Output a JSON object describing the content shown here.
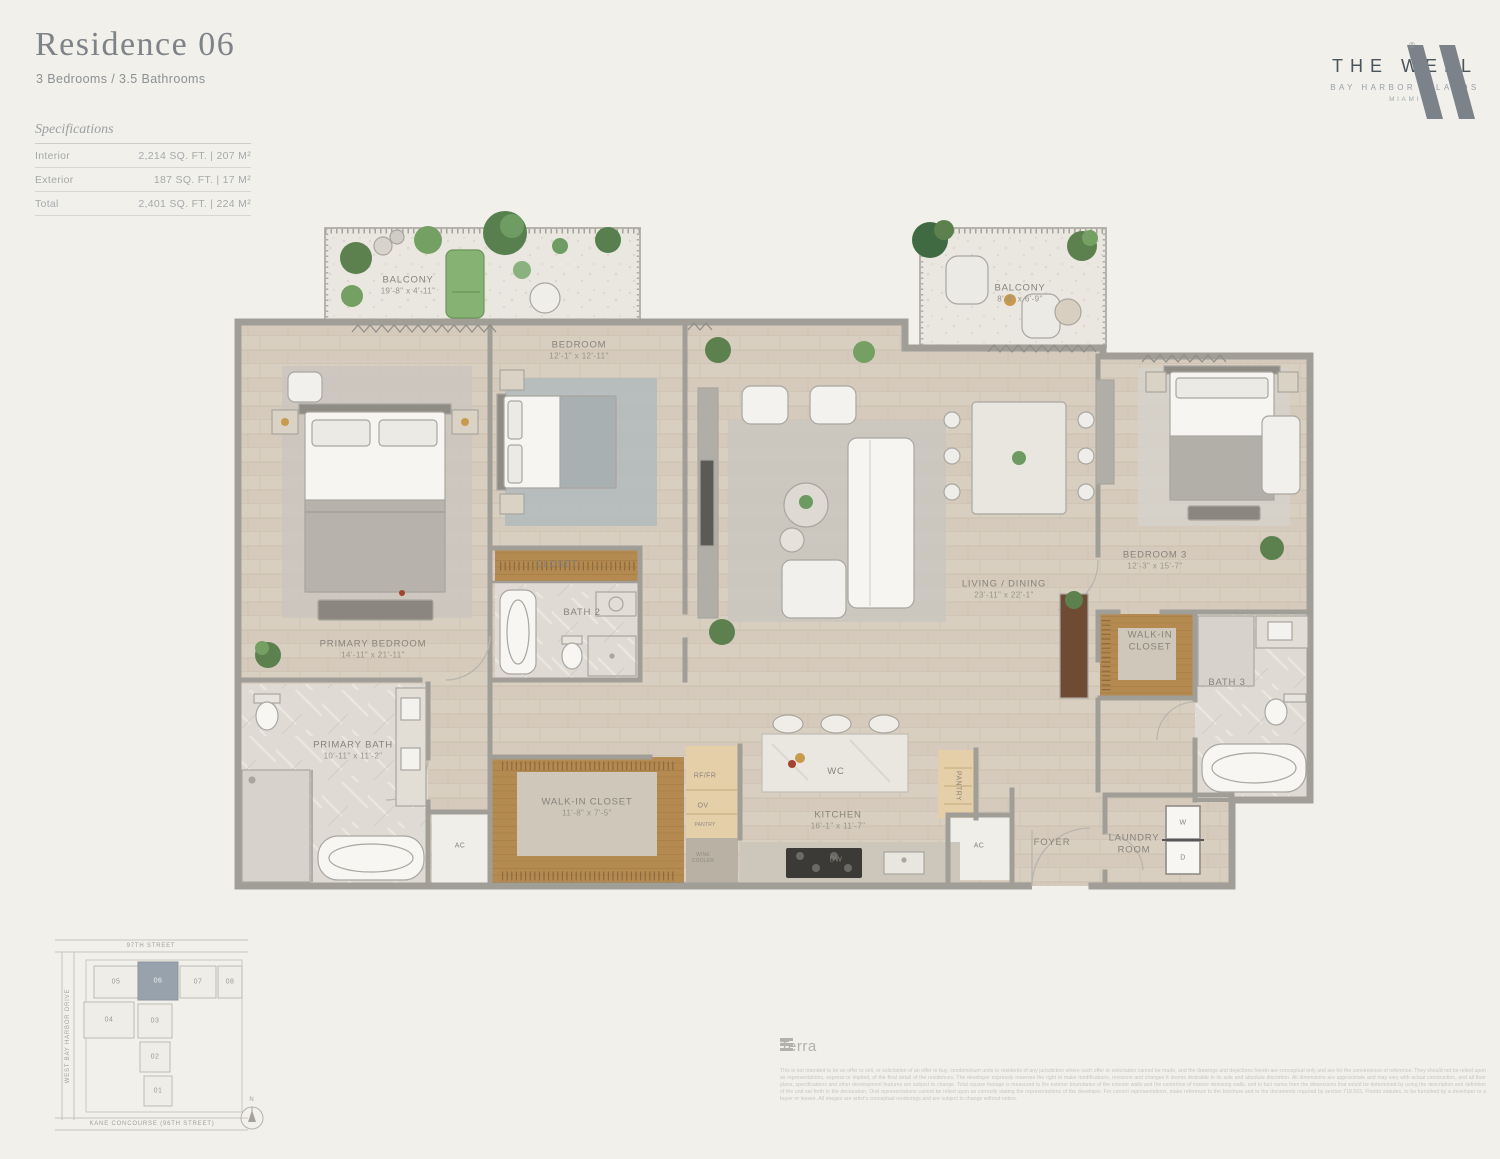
{
  "header": {
    "title": "Residence 06",
    "subtitle": "3 Bedrooms / 3.5 Bathrooms"
  },
  "specs": {
    "heading": "Specifications",
    "rows": [
      {
        "label": "Interior",
        "value": "2,214 SQ. FT.  |  207 M²"
      },
      {
        "label": "Exterior",
        "value": "187 SQ. FT.  |  17 M²"
      },
      {
        "label": "Total",
        "value": "2,401 SQ. FT.  |  224 M²"
      }
    ]
  },
  "brand": {
    "wordmark": "THE WELL",
    "sub": "BAY HARBOR ISLANDS",
    "city": "MIAMI",
    "registered": "®"
  },
  "plan": {
    "labels": {
      "balcony1": {
        "name": "BALCONY",
        "dims": "19'-8\" x 4'-11\""
      },
      "balcony2": {
        "name": "BALCONY",
        "dims": "8'-6\" x 6'-9\""
      },
      "bedroom2": {
        "name": "BEDROOM",
        "dims": "12'-1\" x 12'-11\""
      },
      "living": {
        "name": "LIVING / DINING",
        "dims": "23'-11\" x 22'-1\""
      },
      "bedroom3": {
        "name": "BEDROOM 3",
        "dims": "12'-3\" x 15'-7\""
      },
      "wic3": {
        "line1": "WALK-IN",
        "line2": "CLOSET"
      },
      "primary_bedroom": {
        "name": "PRIMARY BEDROOM",
        "dims": "14'-11\" x 21'-11\""
      },
      "primary_bath": {
        "name": "PRIMARY BATH",
        "dims": "10'-11\" x 11'-2\""
      },
      "closet2": {
        "name": "CLOSET"
      },
      "bath2": {
        "name": "BATH 2"
      },
      "bath3": {
        "name": "BATH 3"
      },
      "wic_primary": {
        "name": "WALK-IN CLOSET",
        "dims": "11'-8\" x 7'-5\""
      },
      "kitchen": {
        "name": "KITCHEN",
        "dims": "16'-1\" x 11'-7\""
      },
      "wc": {
        "name": "WC"
      },
      "dw": {
        "name": "DW"
      },
      "rffr": {
        "name": "RF/FR"
      },
      "ov": {
        "name": "OV"
      },
      "pantry_small": {
        "name": "PANTRY"
      },
      "wine": {
        "line1": "WINE",
        "line2": "COOLER"
      },
      "pantry": {
        "name": "PANTRY"
      },
      "ac1": {
        "name": "AC"
      },
      "ac2": {
        "name": "AC"
      },
      "foyer": {
        "name": "FOYER"
      },
      "laundry": {
        "line1": "LAUNDRY",
        "line2": "ROOM"
      },
      "washer": {
        "name": "W"
      },
      "dryer": {
        "name": "D"
      }
    }
  },
  "siteplan": {
    "street_top": "97TH STREET",
    "street_left": "WEST BAY HARBOR DRIVE",
    "street_bottom": "KANE CONCOURSE (96TH STREET)",
    "north": "N",
    "highlighted_unit": "06",
    "units": {
      "u05": "05",
      "u06": "06",
      "u07": "07",
      "u08": "08",
      "u04": "04",
      "u03": "03",
      "u02": "02",
      "u01": "01"
    }
  },
  "footer": {
    "brand": "Terra",
    "legal": "This is not intended to be an offer to sell, or solicitation of an offer to buy, condominium units to residents of any jurisdiction where such offer or solicitation cannot be made, and the drawings and depictions herein are conceptual only and are for the convenience of reference. They should not be relied upon as representations, express or implied, of the final detail of the residences. The developer expressly reserves the right to make modifications, revisions and changes it deems desirable in its sole and absolute discretion. All dimensions are approximate and may vary with actual construction, and all floor plans, specifications and other development features are subject to change. Total square footage is measured to the exterior boundaries of the exterior walls and the centerline of interior demising walls, and in fact varies from the dimensions that would be determined by using the description and definition of the unit set forth in the declaration. Oral representations cannot be relied upon as correctly stating the representations of the developer. For correct representations, make reference to the brochure and to the documents required by section 718.503, Florida statutes, to be furnished by a developer to a buyer or lessee. All images are artist's conceptual renderings and are subject to change without notice."
  }
}
